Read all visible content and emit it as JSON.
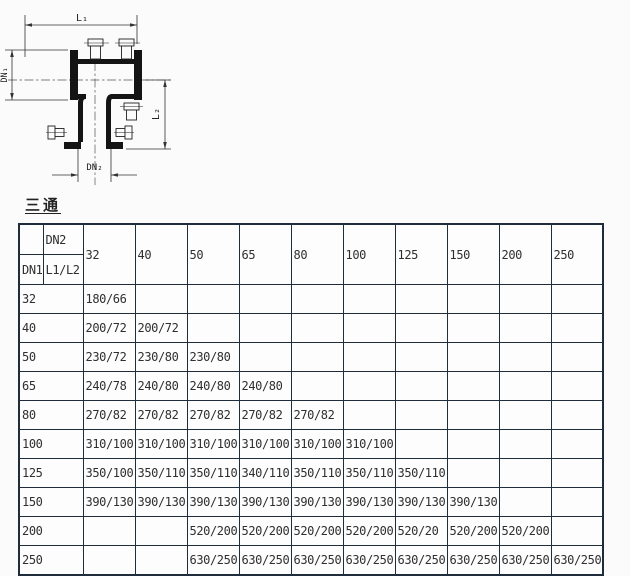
{
  "title": "三通",
  "drawing": {
    "labels": {
      "l1": "L₁",
      "dn1": "DN₁",
      "l2": "L₂",
      "dn2": "DN₂"
    }
  },
  "table": {
    "corner": {
      "dn2": "DN2",
      "dn1": "DN1",
      "l1l2": "L1/L2"
    },
    "columns": [
      "32",
      "40",
      "50",
      "65",
      "80",
      "100",
      "125",
      "150",
      "200",
      "250"
    ],
    "rows": [
      {
        "dn1": "32",
        "cells": [
          "180/66",
          "",
          "",
          "",
          "",
          "",
          "",
          "",
          "",
          ""
        ]
      },
      {
        "dn1": "40",
        "cells": [
          "200/72",
          "200/72",
          "",
          "",
          "",
          "",
          "",
          "",
          "",
          ""
        ]
      },
      {
        "dn1": "50",
        "cells": [
          "230/72",
          "230/80",
          "230/80",
          "",
          "",
          "",
          "",
          "",
          "",
          ""
        ]
      },
      {
        "dn1": "65",
        "cells": [
          "240/78",
          "240/80",
          "240/80",
          "240/80",
          "",
          "",
          "",
          "",
          "",
          ""
        ]
      },
      {
        "dn1": "80",
        "cells": [
          "270/82",
          "270/82",
          "270/82",
          "270/82",
          "270/82",
          "",
          "",
          "",
          "",
          ""
        ]
      },
      {
        "dn1": "100",
        "cells": [
          "310/100",
          "310/100",
          "310/100",
          "310/100",
          "310/100",
          "310/100",
          "",
          "",
          "",
          ""
        ]
      },
      {
        "dn1": "125",
        "cells": [
          "350/100",
          "350/110",
          "350/110",
          "340/110",
          "350/110",
          "350/110",
          "350/110",
          "",
          "",
          ""
        ]
      },
      {
        "dn1": "150",
        "cells": [
          "390/130",
          "390/130",
          "390/130",
          "390/130",
          "390/130",
          "390/130",
          "390/130",
          "390/130",
          "",
          ""
        ]
      },
      {
        "dn1": "200",
        "cells": [
          "",
          "",
          "520/200",
          "520/200",
          "520/200",
          "520/200",
          "520/20",
          "520/200",
          "520/200",
          ""
        ]
      },
      {
        "dn1": "250",
        "cells": [
          "",
          "",
          "630/250",
          "630/250",
          "630/250",
          "630/250",
          "630/250",
          "630/250",
          "630/250",
          "630/250"
        ]
      }
    ]
  }
}
